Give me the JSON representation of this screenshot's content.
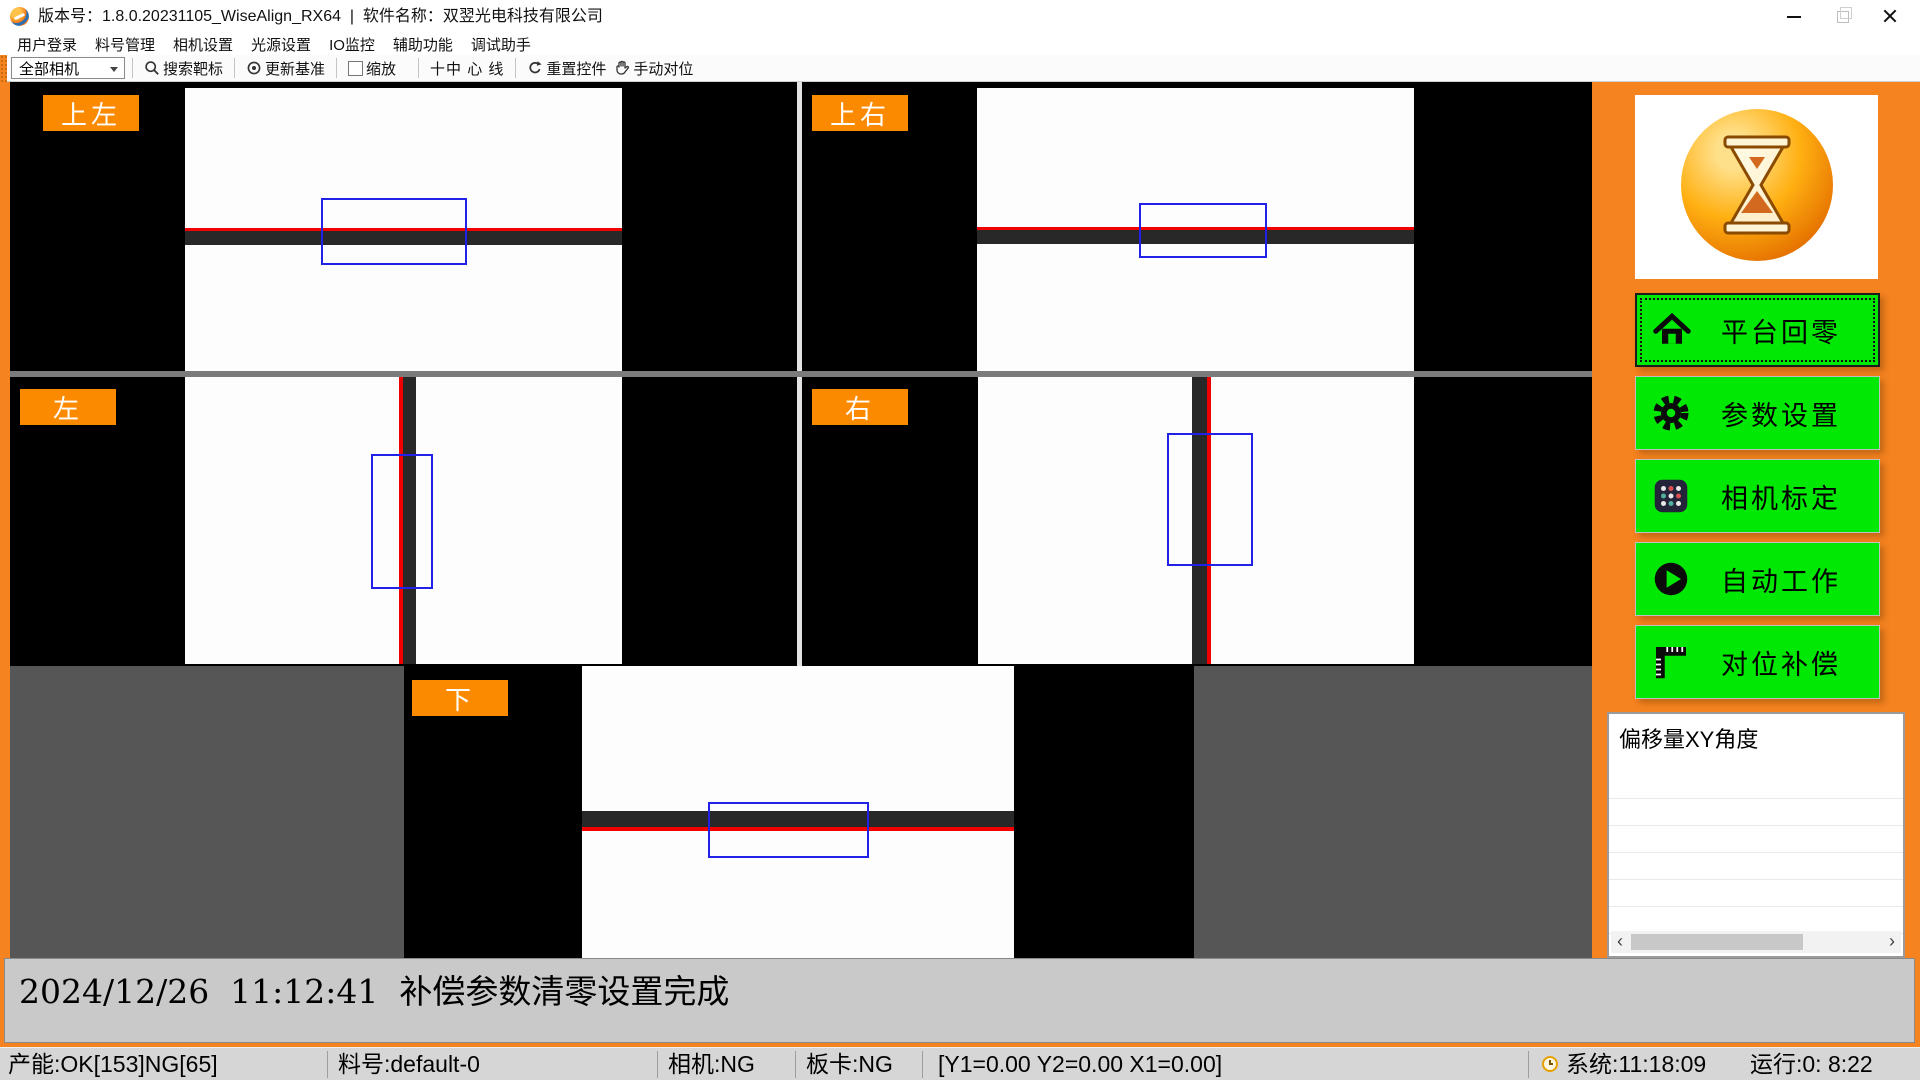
{
  "window": {
    "title": "版本号：1.8.0.20231105_WiseAlign_RX64  |  软件名称：双翌光电科技有限公司",
    "controls": [
      {
        "name": "minimize"
      },
      {
        "name": "maximize-restore"
      },
      {
        "name": "close"
      }
    ]
  },
  "menu": {
    "items": [
      "用户登录",
      "料号管理",
      "相机设置",
      "光源设置",
      "IO监控",
      "辅助功能",
      "调试助手"
    ]
  },
  "toolbar": {
    "camera_select": {
      "value": "全部相机",
      "icon": "chevron-down"
    },
    "buttons": [
      {
        "label": "搜索靶标",
        "icon": "magnifier"
      },
      {
        "label": "更新基准",
        "icon": "target"
      },
      {
        "label": "缩放",
        "icon": "checkbox-unchecked"
      },
      {
        "label": "十中 心 线",
        "icon": "crosshair"
      },
      {
        "label": "重置控件",
        "icon": "reset-arrow"
      },
      {
        "label": "手动对位",
        "icon": "manual-hand"
      }
    ]
  },
  "cameras": [
    {
      "id": "top-left",
      "label": "上左"
    },
    {
      "id": "top-right",
      "label": "上右"
    },
    {
      "id": "left",
      "label": "左"
    },
    {
      "id": "right",
      "label": "右"
    },
    {
      "id": "bottom",
      "label": "下"
    }
  ],
  "sidebar": {
    "logo": "hourglass-logo",
    "buttons": [
      {
        "label": "平台回零",
        "icon": "home"
      },
      {
        "label": "参数设置",
        "icon": "gear"
      },
      {
        "label": "相机标定",
        "icon": "calibration-grid"
      },
      {
        "label": "自动工作",
        "icon": "play"
      },
      {
        "label": "对位补偿",
        "icon": "ruler"
      }
    ]
  },
  "offset_panel": {
    "title": "偏移量XY角度",
    "rows": [
      "",
      "",
      "",
      "",
      "",
      "",
      ""
    ],
    "scrollbar": {
      "left_arrow": "‹",
      "right_arrow": "›"
    }
  },
  "status_message": {
    "text": "2024/12/26  11:12:41  补偿参数清零设置完成"
  },
  "status_bar": {
    "yield": "产能:OK[153]NG[65]",
    "part_no": "料号:default-0",
    "camera": "相机:NG",
    "board": "板卡:NG",
    "coords": "[Y1=0.00 Y2=0.00 X1=0.00]",
    "clock_icon": "clock",
    "system": "系统:11:18:09",
    "runtime": "运行:0: 8:22"
  },
  "colors": {
    "accent_orange": "#F5831F",
    "label_orange": "#FC8A00",
    "button_green": "#00E803",
    "roi_blue": "#2121E8",
    "line_red": "#F00100",
    "row3_gray": "#565656"
  }
}
